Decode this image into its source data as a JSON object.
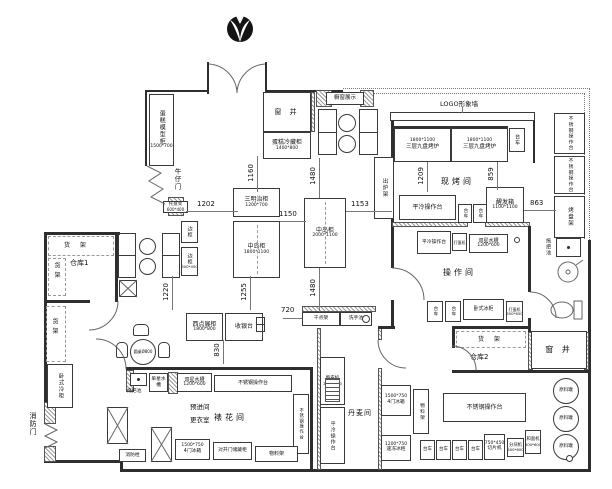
{
  "plan": {
    "rooms": {
      "bake": "现烤间",
      "op": "操作间",
      "danish": "丹麦间",
      "deco": "裱花间",
      "pre1": "预进间",
      "pre2": "更衣室",
      "store1": "仓库1",
      "store2": "仓库2",
      "well": "窗 井",
      "firedoor": "消防门",
      "saloon": "牛仔门"
    },
    "features": {
      "logo_wall": "LOGO形象墙",
      "showcase": "橱窗展示"
    },
    "furniture": {
      "cake_model": {
        "label": "蛋糕模型柜",
        "size": "1500*700"
      },
      "cake_fridge": {
        "label": "蛋糕冷藏柜",
        "size": "1400*800"
      },
      "sandwich": {
        "label": "三明治柜",
        "size": "1200*700"
      },
      "island1": {
        "label": "中岛柜",
        "size": "1800*1100"
      },
      "island2": {
        "label": "中岛柜",
        "size": "2000*1100"
      },
      "oven": {
        "label": "三层九盘烤炉",
        "size": "1800*1100"
      },
      "proofer": {
        "label": "醒发箱",
        "size": "1100*1100"
      },
      "trolley": "台车",
      "cold_table": "平冷操作台",
      "steel_table": "不锈钢操作台",
      "rack_out": "出炉架",
      "rack_tray": "烤盘架",
      "mop_sink": "拖把池",
      "sink1": "单星水槽",
      "sink2": {
        "label": "双星水槽",
        "size": "1200*600"
      },
      "egg_mixer": {
        "label": "打蛋机",
        "size": "650*650"
      },
      "chest_freezer": "卧式冰柜",
      "chest_cooler": "卧式冷柜",
      "shelf": "货 架",
      "material_rack": "物料架",
      "fridge4": {
        "label": "4门冰箱",
        "size": "1500*750"
      },
      "quick_freezer": {
        "label": "速冻冰柜",
        "size": "1200*750"
      },
      "sheeter": {
        "label": "酥皮机",
        "size": "2350*850"
      },
      "slicer": {
        "label": "切片机",
        "size": "750*450"
      },
      "divider_m": {
        "label": "分块机",
        "size": "600*600"
      },
      "dough_mixer": {
        "label": "和面机",
        "size": "600*600"
      },
      "tank": "原料罐",
      "pastry_case": {
        "label": "西点展柜",
        "size": "1800*800"
      },
      "cashier": "收银台",
      "dry_rack": "干点架",
      "wash_basin": "洗手池",
      "side_cab": {
        "label": "边柜",
        "size": "900*450"
      },
      "tray_rack2": {
        "label": "托盘架",
        "size": "600*400"
      },
      "round_table": "圆桌Ø800",
      "double_door_cab": "对开门储藏柜",
      "hydrant": "消防栓"
    },
    "dims": {
      "d1202": "1202",
      "d1160": "1160",
      "d1150": "1150",
      "d1153": "1153",
      "d1480": "1480",
      "d1209": "1209",
      "d859": "859",
      "d863": "863",
      "d1220": "1220",
      "d1255": "1255",
      "d830": "830",
      "d720": "720"
    }
  }
}
